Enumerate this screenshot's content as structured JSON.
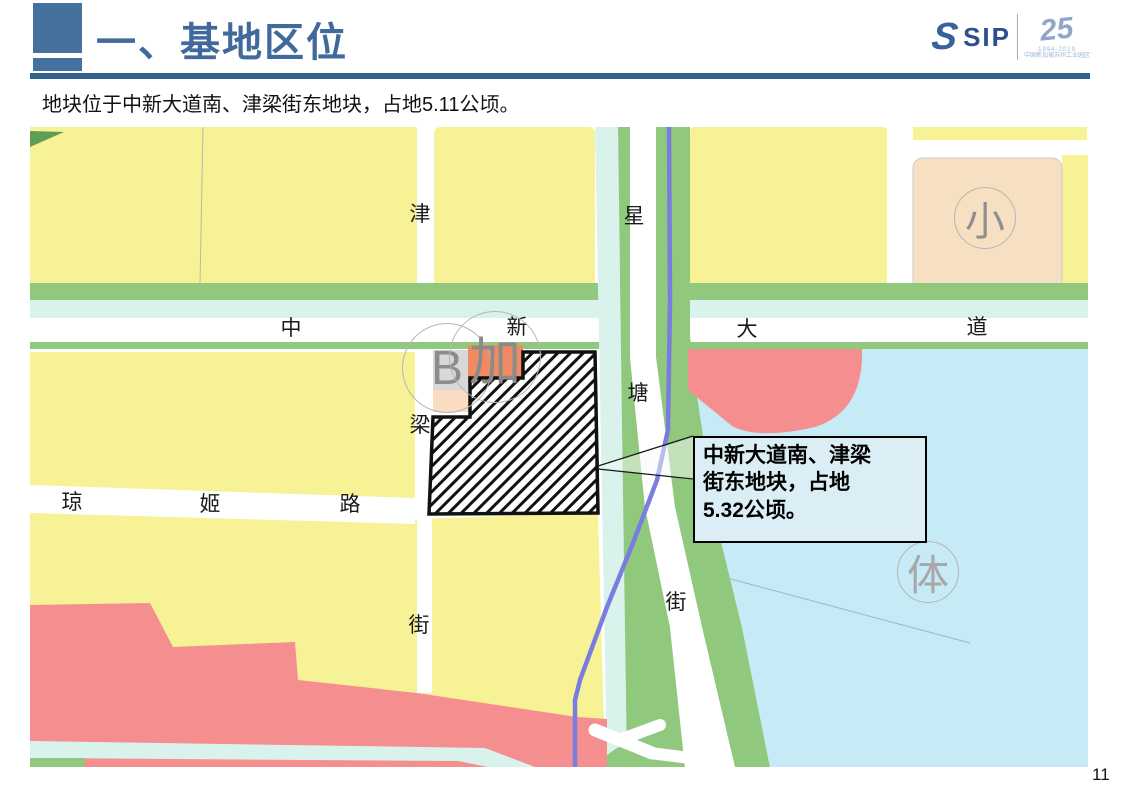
{
  "header": {
    "title": "一、基地区位"
  },
  "logo": {
    "s_mark": "S",
    "name": "SIP",
    "anniversary": "25",
    "years": "1994-2019",
    "org_line": "中国新加坡苏州工业园区"
  },
  "intro": "地块位于中新大道南、津梁街东地块，占地5.11公顷。",
  "page_number": "11",
  "map": {
    "road_labels": {
      "jin": "津",
      "xing": "星",
      "zhong": "中",
      "xin": "新",
      "da": "大",
      "dao": "道",
      "liang": "梁",
      "tang": "塘",
      "qiong": "琼",
      "ji": "姬",
      "lu": "路",
      "jie_left": "街",
      "jie_right": "街"
    },
    "area_labels": {
      "b": "B",
      "jia": "加",
      "xiao": "小",
      "ti": "体"
    },
    "callout": {
      "lines": [
        "中新大道南、津梁",
        "街东地块，占地",
        "5.32公顷。"
      ]
    },
    "colors": {
      "parcel_yellow": "#f7f295",
      "green": "#90c87e",
      "green_dark": "#5f9e54",
      "canal": "#d9f3ec",
      "lake": "#c6eaf6",
      "pink": "#f58f8f",
      "salmon": "#f08a62",
      "peach": "#f7dfc1",
      "peach_light": "#fadcc3",
      "gray_parcel": "#d8d8d8",
      "metro": "#7a7ce0",
      "callout_bg": "#dceef5",
      "accent_blue": "#46719f",
      "rule_blue": "#32608f",
      "title_blue": "#41699c"
    }
  }
}
